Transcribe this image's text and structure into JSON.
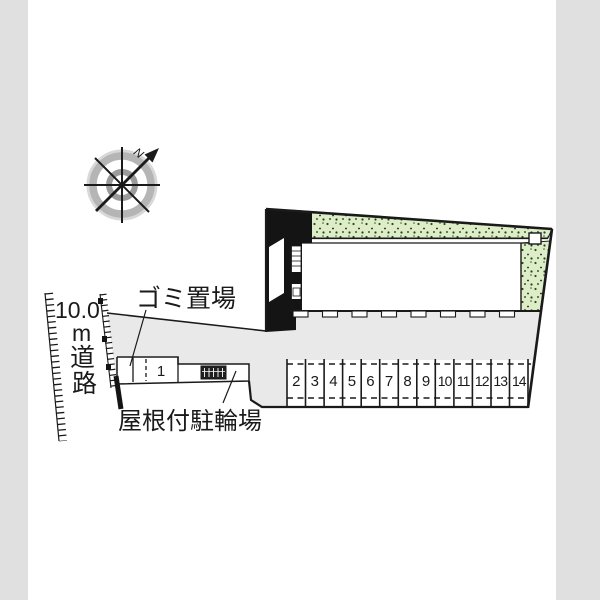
{
  "plan": {
    "compass": {
      "north": "N"
    },
    "road": {
      "lines": [
        "10.0",
        "m",
        "道",
        "路"
      ],
      "full_label": "10.0m道路"
    },
    "garbage_area_label": "ゴミ置場",
    "bicycle_parking_label": "屋根付駐輪場",
    "parking_stalls": {
      "stall_1": "1",
      "numbers": [
        "2",
        "3",
        "4",
        "5",
        "6",
        "7",
        "8",
        "9",
        "10",
        "11",
        "12",
        "13",
        "14"
      ]
    },
    "colors": {
      "page_margin": "#e0e0e0",
      "sheet": "#ffffff",
      "driveway": "#e9e9e9",
      "greenery": "#dcedc8",
      "outline": "#1a1a1a",
      "compass_ring_outer": "#b5b5b5",
      "compass_ring_inner": "#9b9b9b"
    }
  }
}
